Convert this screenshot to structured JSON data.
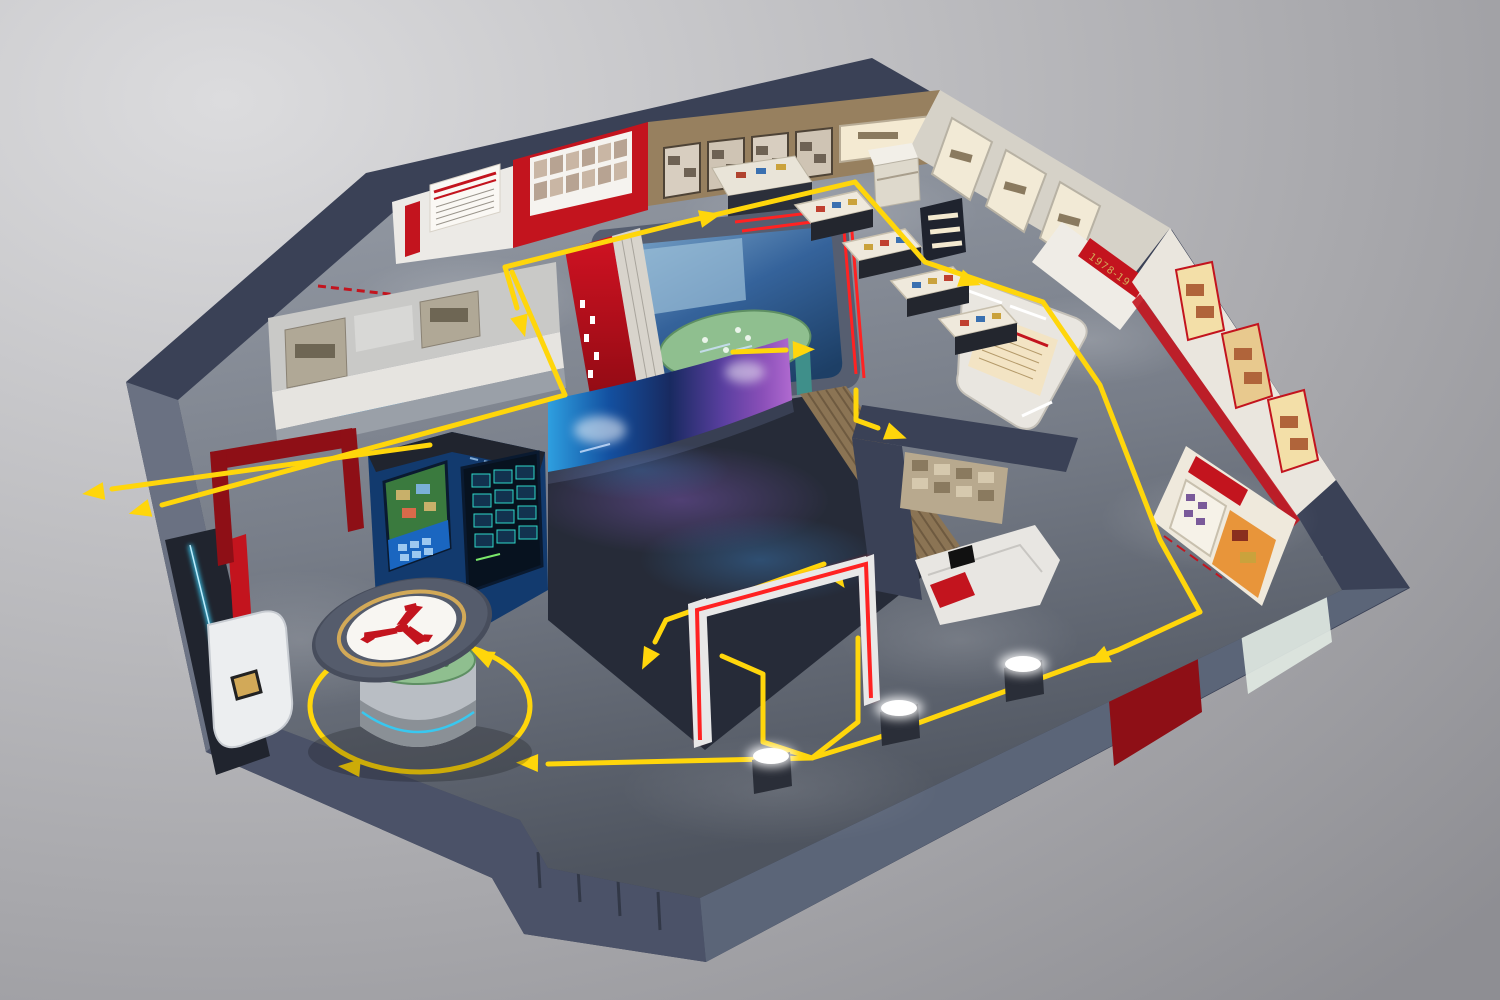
{
  "scene": {
    "title": "3D exhibition hall cutaway with yellow visitor route",
    "view": "isometric cutaway render on grey studio background",
    "colors": {
      "bg1": "#dcdcde",
      "bg2": "#8e8e93",
      "shell": "#3a4156",
      "shellLight": "#525a72",
      "shellDark": "#272d3d",
      "wallFaceL": "#6a7182",
      "wallFaceBL": "#4b5268",
      "wallFaceBR": "#5b6578",
      "floorTop": "#9aa0aa",
      "floorBottom": "#4e545f",
      "route": "#ffd60b",
      "red": "#c3141e",
      "darkRed": "#8e0f16",
      "neonRed": "#ff2222",
      "white": "#eceae6",
      "cream": "#f3e4c4",
      "brown": "#97805f",
      "wood": "#8b7454",
      "domeBlue": "#35639b",
      "deepBlue": "#14396b",
      "brightBlue": "#29a3f0",
      "screenCyan": "#2e9fe0",
      "screenViolet": "#8a4fb8",
      "green": "#8fbf8f",
      "gold": "#d2a958",
      "navyPanel": "#20242e",
      "cyanNeon": "#38c8f0",
      "sepia": "#b8a98e",
      "glassGreen": "#dfe8e2"
    },
    "route": {
      "color": "#ffd60b",
      "style": "solid floor line with triangular direction arrows",
      "arrow_count": 13,
      "kiosk_loop": true,
      "theater_in_out_spur": true
    },
    "zones": [
      {
        "id": "intro-wall",
        "desc": "white wall with red-striped timeline poster and red vertical banner"
      },
      {
        "id": "portrait-wall",
        "desc": "curved red wall, white panel with two rows of six portrait photos",
        "portraits": 12
      },
      {
        "id": "history-wall",
        "desc": "tan wall with framed black-and-white photo displays, lit artifact case and low showcase"
      },
      {
        "id": "artifact-vitrines",
        "desc": "free-standing glass display tables",
        "count": 4
      },
      {
        "id": "alcove-niches",
        "desc": "illuminated white display niches",
        "count": 3
      },
      {
        "id": "era-banner",
        "desc": "red wall band with gold year range",
        "text": "1978-19"
      },
      {
        "id": "right-gallery",
        "desc": "white wall with red-framed gold poster displays and red trim"
      },
      {
        "id": "orange-alcove",
        "desc": "recessed display with red title banner, stamp grid and orange artifact board"
      },
      {
        "id": "rounded-stand",
        "desc": "rounded white stand with cream poster and slatted light screens"
      },
      {
        "id": "immersive-room",
        "desc": "dome projection room with blue screen, green terrain sand table, red entry wall, double red stripe trim"
      },
      {
        "id": "theater",
        "desc": "dark reflective hall, curved LED screen with violet-blue cosmic visuals, wood-slat wall, red neon gate"
      },
      {
        "id": "vintage-room",
        "desc": "sepia photo wall with white stepped platform, red accent and small screen"
      },
      {
        "id": "interactive-alcove",
        "desc": "royal-blue niche with city-map touchscreen and dark data dashboard"
      },
      {
        "id": "central-kiosk",
        "desc": "cylindrical sand-table pedestal with hovering disc, gold ring and red tri-blade logo"
      },
      {
        "id": "photo-counter",
        "desc": "left wall counter with black-and-white photo strip and bright blue screen"
      },
      {
        "id": "entrance",
        "desc": "reception desk with gold guest book, cyan neon wall, dark-red portal frame, red column"
      },
      {
        "id": "light-pedestals",
        "desc": "glowing cylinder pedestals",
        "count": 3
      },
      {
        "id": "exit-wall",
        "desc": "blue-grey outer wall with dark red doorway and frosted glass pane"
      }
    ]
  },
  "labels": {
    "era_banner": "1978-19"
  }
}
